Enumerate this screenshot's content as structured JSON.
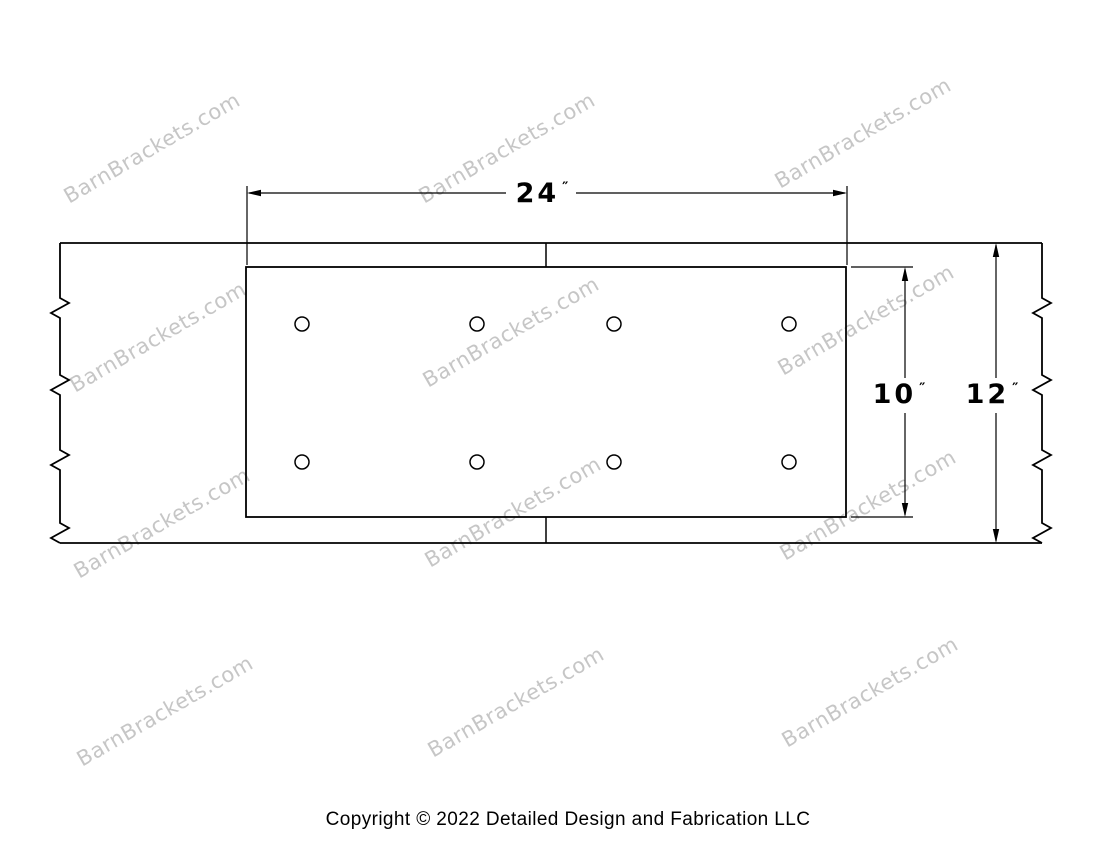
{
  "watermark": {
    "text": "BarnBrackets.com",
    "color": "#c6c6c6",
    "angle_deg": -30,
    "positions": [
      {
        "x": 152,
        "y": 148
      },
      {
        "x": 507,
        "y": 148
      },
      {
        "x": 863,
        "y": 133
      },
      {
        "x": 158,
        "y": 337
      },
      {
        "x": 511,
        "y": 332
      },
      {
        "x": 866,
        "y": 320
      },
      {
        "x": 162,
        "y": 523
      },
      {
        "x": 513,
        "y": 512
      },
      {
        "x": 868,
        "y": 505
      },
      {
        "x": 165,
        "y": 711
      },
      {
        "x": 516,
        "y": 702
      },
      {
        "x": 870,
        "y": 692
      }
    ]
  },
  "dimensions": {
    "width": {
      "value": "24",
      "unit": "″"
    },
    "plate_height": {
      "value": "10",
      "unit": "″"
    },
    "beam_height": {
      "value": "12",
      "unit": "″"
    }
  },
  "drawing": {
    "line_color": "#000000",
    "beam": {
      "left_x": 60,
      "right_x": 1042,
      "top_y": 243,
      "bottom_y": 543
    },
    "plate": {
      "left": 246,
      "top": 267,
      "right": 846,
      "bottom": 517
    },
    "holes": {
      "radius": 7,
      "columns_x": [
        302,
        477,
        614,
        789
      ],
      "rows_y": [
        324,
        462
      ]
    },
    "break_ys": [
      308,
      385,
      460,
      533
    ]
  },
  "footer": {
    "copyright": "Copyright © 2022 Detailed Design and Fabrication LLC"
  }
}
